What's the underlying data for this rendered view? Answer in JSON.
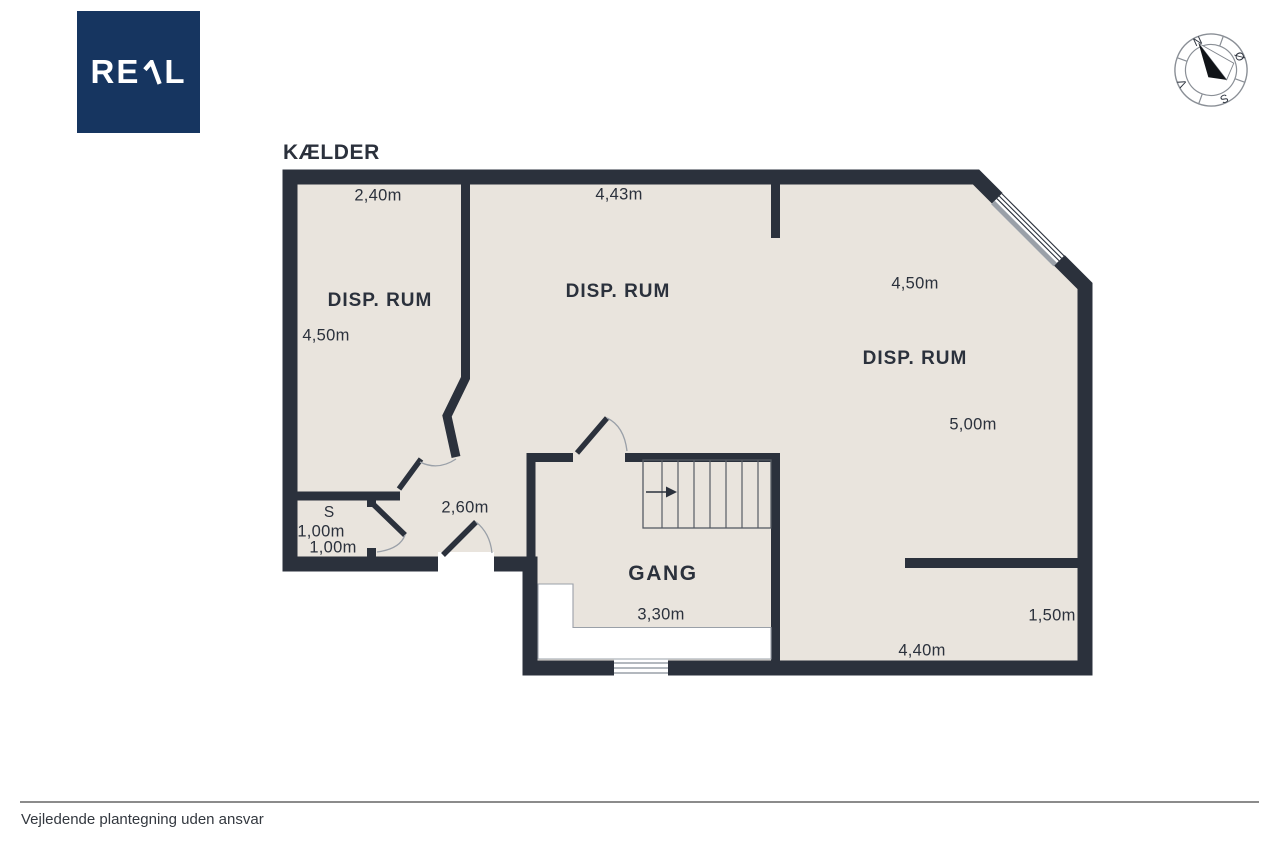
{
  "page": {
    "title": "KÆLDER",
    "footer_disclaimer": "Vejledende plantegning uden ansvar",
    "background": "#ffffff"
  },
  "logo": {
    "name": "REAL",
    "prefix": "RE",
    "suffix": "L",
    "bg_color": "#163560",
    "text_color": "#ffffff"
  },
  "compass": {
    "north": "N",
    "east": "Ø",
    "south": "S",
    "west": "V"
  },
  "plan": {
    "wall_color": "#2b313c",
    "floor_color": "#e9e4dd",
    "rooms": {
      "disp_rum_left": {
        "name": "DISP. RUM",
        "width": "2,40m",
        "depth": "4,50m"
      },
      "disp_rum_mid": {
        "name": "DISP. RUM",
        "width": "4,43m"
      },
      "disp_rum_right": {
        "name": "DISP. RUM",
        "width": "4,50m",
        "depth": "5,00m"
      },
      "gang": {
        "name": "GANG",
        "width": "3,30m"
      },
      "s_room": {
        "name": "S",
        "width": "1,00m",
        "depth": "1,00m"
      },
      "hall": {
        "width": "2,60m"
      },
      "right_section": {
        "recess": "1,50m",
        "width": "4,40m"
      }
    }
  }
}
